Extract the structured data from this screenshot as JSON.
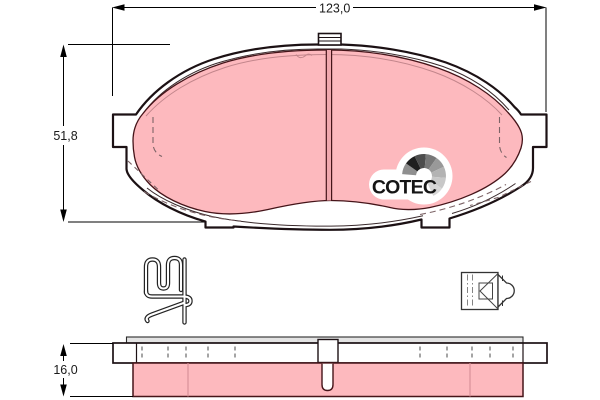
{
  "dimensions": {
    "width_label": "123,0",
    "height_label": "51,8",
    "thickness_label": "16,0"
  },
  "logo": {
    "brand": "COTEC"
  },
  "colors": {
    "friction_pink": "#fdb9be",
    "friction_groove_pink": "#f1a8ae",
    "friction_edge": "#451419",
    "outline": "#1c1114",
    "dimension_line": "#000000",
    "logo_text": "#151515",
    "background": "#ffffff"
  }
}
